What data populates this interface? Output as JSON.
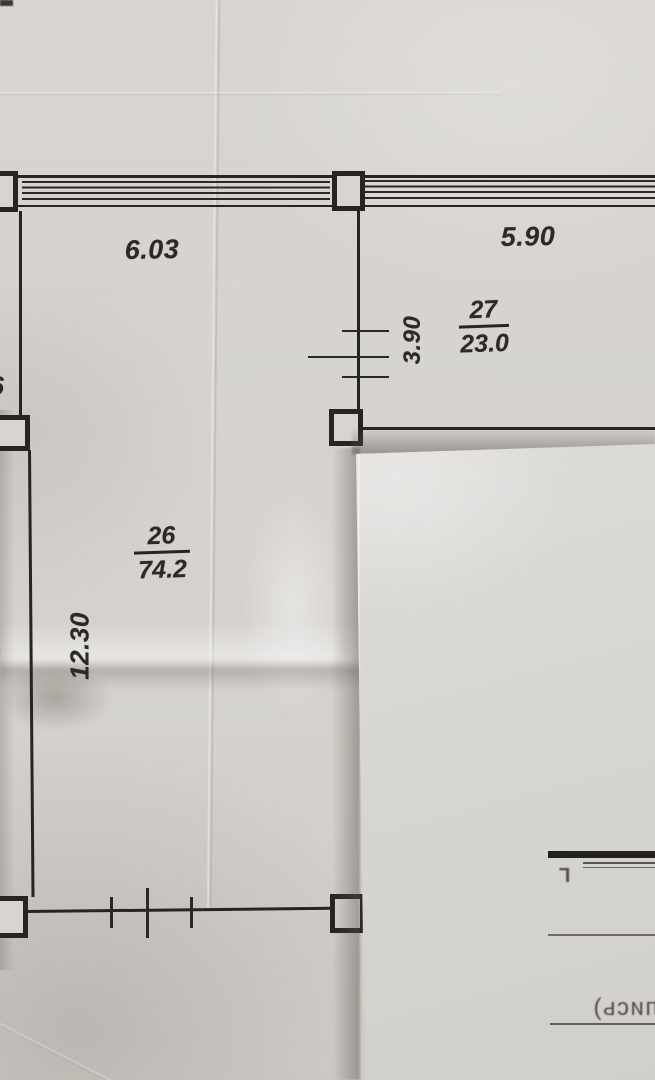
{
  "plan": {
    "dimensions": {
      "top_left": "6.03",
      "top_right": "5.90",
      "mid_vertical": "3.90",
      "left_vertical": "12.30"
    },
    "left_edge_fragment": "6",
    "rooms": [
      {
        "number": "27",
        "area": "23.0"
      },
      {
        "number": "26",
        "area": "74.2"
      }
    ]
  },
  "overlay": {
    "bleed_word_mirrored": "пись)",
    "bleed_letter_mirrored": "Г"
  },
  "colors": {
    "ink": "#26251f",
    "paper": "#d6d3ce",
    "overlay_paper": "#d8d6d2",
    "bleed_ink": "#524e49"
  }
}
